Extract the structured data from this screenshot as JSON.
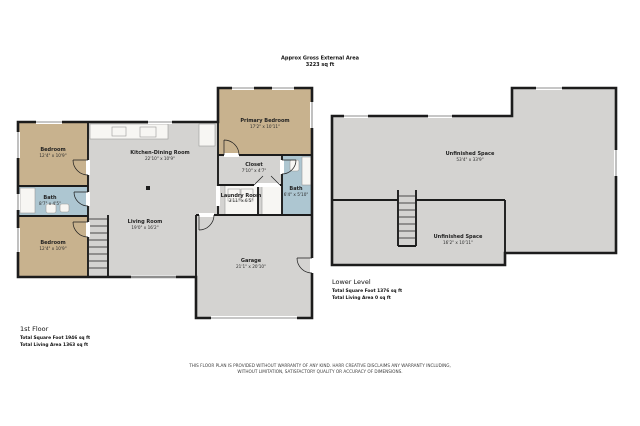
{
  "header": {
    "line1": "Approx Gross External Area",
    "line2": "3223 sq ft"
  },
  "colors": {
    "wall": "#1c1c1c",
    "room": "#d4d3d1",
    "bedroom": "#c8b28e",
    "bath": "#adc6d1",
    "fixture": "#f7f6f3"
  },
  "first_floor": {
    "title": "1st Floor",
    "total_square_foot": "Total Square Foot 1946 sq ft",
    "total_living_area": "Total Living Area 1363 sq ft",
    "rooms": {
      "bedroom_top": {
        "name": "Bedroom",
        "dims": "12'4\" x 10'9\""
      },
      "bath_left": {
        "name": "Bath",
        "dims": "8'7\" x 4'5\""
      },
      "bedroom_bottom": {
        "name": "Bedroom",
        "dims": "12'4\" x 10'9\""
      },
      "kitchen_dining": {
        "name": "Kitchen-Dining Room",
        "dims": "22'10\" x 10'9\""
      },
      "living_room": {
        "name": "Living Room",
        "dims": "19'0\" x 16'2\""
      },
      "primary_bedroom": {
        "name": "Primary Bedroom",
        "dims": "17'2\" x 10'11\""
      },
      "closet": {
        "name": "Closet",
        "dims": "7'10\" x 4'7\""
      },
      "laundry": {
        "name": "Laundry Room",
        "dims": "3'11\" x 6'5\""
      },
      "bath_right": {
        "name": "Bath",
        "dims": "6'4\" x 5'10\""
      },
      "garage": {
        "name": "Garage",
        "dims": "21'1\" x 20'10\""
      }
    }
  },
  "lower_level": {
    "title": "Lower Level",
    "total_square_foot": "Total Square Foot 1376 sq ft",
    "total_living_area": "Total Living Area 0 sq ft",
    "rooms": {
      "unfinished_main": {
        "name": "Unfinished Space",
        "dims": "53'4\" x 33'9\""
      },
      "unfinished_small": {
        "name": "Unfinished Space",
        "dims": "16'2\" x 10'11\""
      }
    }
  },
  "footer": {
    "disclaimer_line1": "THIS FLOOR PLAN IS PROVIDED WITHOUT WARRANTY OF ANY KIND. HARR CREATIVE DISCLAIMS ANY WARRANTY INCLUDING,",
    "disclaimer_line2": "WITHOUT LIMITATION, SATISFACTORY QUALITY OR ACCURACY OF DIMENSIONS."
  }
}
